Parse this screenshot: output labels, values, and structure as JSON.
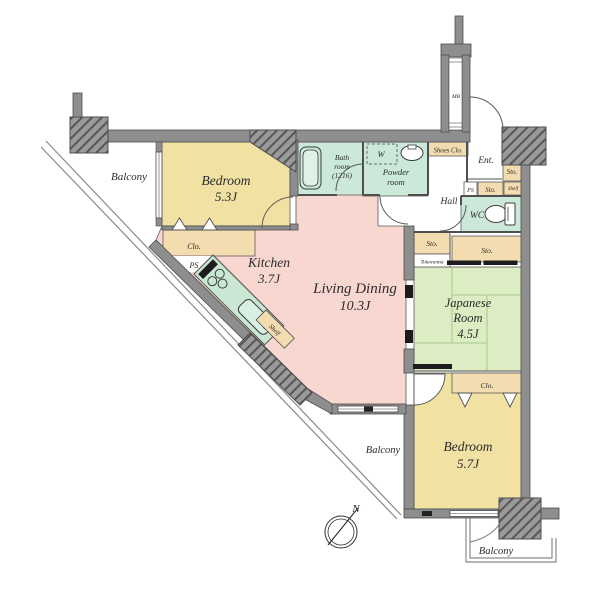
{
  "plan_title": "apartment-floor-plan",
  "colors": {
    "bedroom": "#F1E2A3",
    "living": "#F9D7D1",
    "tatami": "#DCEDC4",
    "wet": "#CBE8D8",
    "storage": "#F3DCB0",
    "wall": "#8E8E8E",
    "tub": "#DFF2E8",
    "counter": "#C9E7D3"
  },
  "rooms": {
    "bedroom1": {
      "name": "Bedroom",
      "size": "5.3J"
    },
    "kitchen": {
      "name": "Kitchen",
      "size": "3.7J"
    },
    "living": {
      "name": "Living Dining",
      "size": "10.3J"
    },
    "japanese": {
      "line1": "Japanese",
      "line2": "Room",
      "size": "4.5J"
    },
    "bedroom2": {
      "name": "Bedroom",
      "size": "5.7J"
    },
    "bath": {
      "line1": "Bath",
      "line2": "room",
      "line3": "(1216)"
    },
    "powder": {
      "line1": "Powder",
      "line2": "room"
    },
    "wc": "WC",
    "hall": "Hall",
    "entrance": "Ent."
  },
  "labels": {
    "balcony": "Balcony",
    "clo": "Clo.",
    "sto": "Sto.",
    "ps": "PS",
    "shelf": "Shelf",
    "shoes_clo": "Shoes Clo.",
    "tokonoma": "Tokonoma",
    "mb": "MB",
    "washer": "W",
    "north": "N"
  }
}
